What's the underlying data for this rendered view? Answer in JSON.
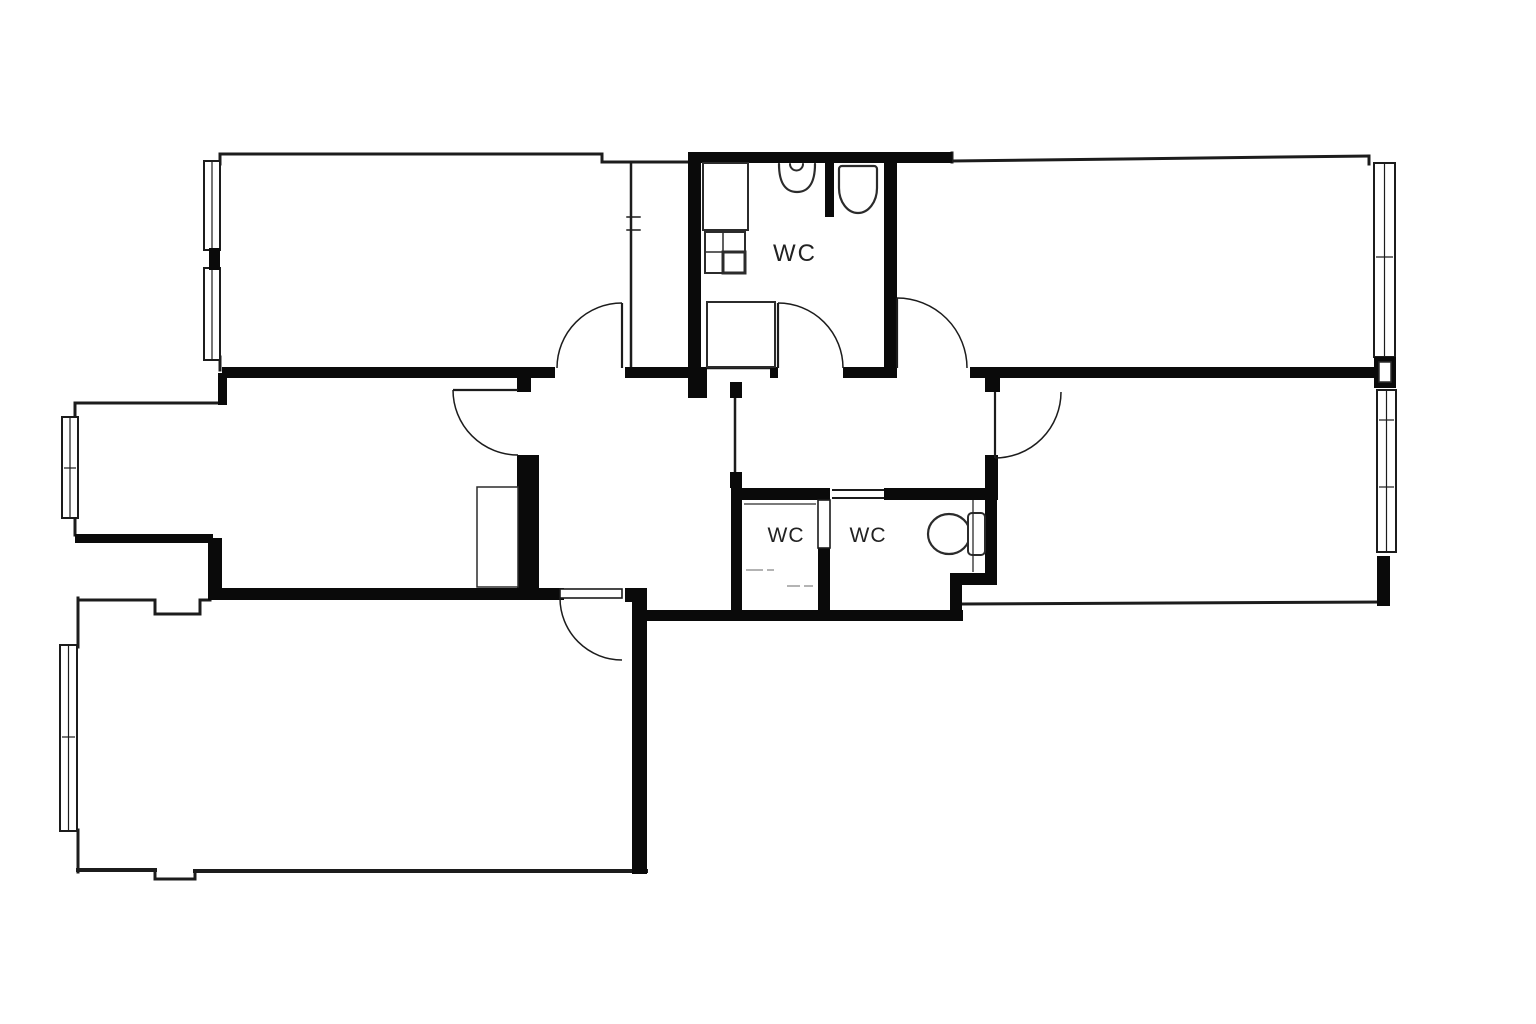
{
  "canvas": {
    "width": 1536,
    "height": 1024,
    "background": "#ffffff",
    "wall_color": "#0a0a0a",
    "line_color": "#1c1c1c",
    "fixture_color": "#2b2b2b",
    "muted_color": "#9a9a9a",
    "label_color": "#222222"
  },
  "labels": [
    {
      "id": "wc-top-label",
      "text": "WC",
      "x": 795,
      "y": 261,
      "size": 24,
      "spacing": 2
    },
    {
      "id": "wc-left-label",
      "text": "WC",
      "x": 786,
      "y": 542,
      "size": 21,
      "spacing": 1
    },
    {
      "id": "wc-right-label",
      "text": "WC",
      "x": 868,
      "y": 542,
      "size": 21,
      "spacing": 1
    }
  ],
  "thick_walls": [
    {
      "name": "spine-wall-a",
      "r": [
        222,
        367,
        333,
        11
      ]
    },
    {
      "name": "spine-wall-b",
      "r": [
        625,
        367,
        82,
        11
      ]
    },
    {
      "name": "spine-wall-jamb",
      "r": [
        770,
        367,
        8,
        11
      ]
    },
    {
      "name": "spine-wall-c",
      "r": [
        843,
        367,
        50,
        11
      ]
    },
    {
      "name": "spine-wall-d",
      "r": [
        970,
        367,
        407,
        11
      ]
    },
    {
      "name": "right-room-door-stub",
      "r": [
        985,
        375,
        15,
        17
      ]
    },
    {
      "name": "wc-top-north-wall",
      "r": [
        688,
        152,
        264,
        11
      ]
    },
    {
      "name": "wc-top-west-wall",
      "r": [
        688,
        152,
        13,
        226
      ]
    },
    {
      "name": "wc-top-west-corner",
      "r": [
        688,
        367,
        19,
        31
      ]
    },
    {
      "name": "wc-top-east-wall",
      "r": [
        884,
        152,
        13,
        226
      ]
    },
    {
      "name": "wc-top-toilet-partition",
      "r": [
        825,
        152,
        9,
        65
      ]
    },
    {
      "name": "left-room-jog",
      "r": [
        218,
        373,
        9,
        32
      ]
    },
    {
      "name": "middle-left-south-wall-a",
      "r": [
        75,
        534,
        138,
        9
      ]
    },
    {
      "name": "middle-left-south-stub",
      "r": [
        208,
        538,
        14,
        56
      ]
    },
    {
      "name": "hall-south-wall",
      "r": [
        208,
        588,
        356,
        12
      ]
    },
    {
      "name": "hall-west-stub",
      "r": [
        517,
        378,
        14,
        14
      ]
    },
    {
      "name": "hall-west-wall",
      "r": [
        517,
        455,
        22,
        135
      ]
    },
    {
      "name": "door5-jamb",
      "r": [
        625,
        588,
        22,
        14
      ]
    },
    {
      "name": "bottom-room-east-wall",
      "r": [
        632,
        598,
        15,
        276
      ]
    },
    {
      "name": "south-exterior-wall",
      "r": [
        643,
        610,
        320,
        11
      ]
    },
    {
      "name": "passage-post-top",
      "r": [
        730,
        382,
        12,
        16
      ]
    },
    {
      "name": "passage-post-bottom",
      "r": [
        730,
        472,
        12,
        16
      ]
    },
    {
      "name": "wc-left-west-wall",
      "r": [
        731,
        488,
        11,
        125
      ]
    },
    {
      "name": "wc-left-north-wall",
      "r": [
        731,
        488,
        99,
        12
      ]
    },
    {
      "name": "wc-divider-wall",
      "r": [
        818,
        548,
        12,
        65
      ]
    },
    {
      "name": "wc-right-north-wall",
      "r": [
        884,
        488,
        113,
        12
      ]
    },
    {
      "name": "wc-right-east-stub",
      "r": [
        985,
        455,
        13,
        45
      ]
    },
    {
      "name": "wc-right-east-wall",
      "r": [
        985,
        488,
        12,
        97
      ]
    },
    {
      "name": "wc-right-jut-h",
      "r": [
        950,
        573,
        47,
        12
      ]
    },
    {
      "name": "wc-right-jut-v",
      "r": [
        950,
        573,
        12,
        48
      ]
    },
    {
      "name": "window-junction-block",
      "r": [
        1374,
        357,
        22,
        31
      ]
    },
    {
      "name": "southeast-corner-wall",
      "r": [
        1377,
        556,
        13,
        50
      ]
    },
    {
      "name": "window-pier-left",
      "r": [
        209,
        248,
        11,
        22
      ]
    }
  ],
  "thin_walls": [
    {
      "name": "top-left-north-wall",
      "l": [
        222,
        154,
        602,
        154
      ],
      "w": 3
    },
    {
      "name": "top-left-north-jog-v",
      "l": [
        602,
        154,
        602,
        162
      ],
      "w": 3
    },
    {
      "name": "top-left-north-wall-b",
      "l": [
        602,
        162,
        690,
        162
      ],
      "w": 3
    },
    {
      "name": "top-left-west-stub-top",
      "l": [
        220,
        154,
        220,
        164
      ],
      "w": 3
    },
    {
      "name": "top-left-west-stub-bottom",
      "l": [
        220,
        357,
        220,
        370
      ],
      "w": 3
    },
    {
      "name": "shaft-west-wall",
      "l": [
        631,
        163,
        631,
        367
      ],
      "w": 2.5
    },
    {
      "name": "shaft-pilaster-a",
      "l": [
        627,
        217,
        640,
        217
      ],
      "w": 1.5
    },
    {
      "name": "shaft-pilaster-b",
      "l": [
        627,
        230,
        640,
        230
      ],
      "w": 1.5
    },
    {
      "name": "top-right-notch",
      "l": [
        952,
        153,
        952,
        162
      ],
      "w": 3
    },
    {
      "name": "top-right-north-wall",
      "l": [
        952,
        161,
        1369,
        156
      ],
      "w": 3
    },
    {
      "name": "top-right-ne-corner",
      "l": [
        1369,
        156,
        1369,
        164
      ],
      "w": 3
    },
    {
      "name": "right-room-south-wall",
      "l": [
        962,
        604,
        1386,
        602
      ],
      "w": 3
    },
    {
      "name": "shower-threshold",
      "l": [
        707,
        368,
        770,
        368
      ],
      "w": 2.5
    },
    {
      "name": "passage-screen",
      "l": [
        735,
        398,
        735,
        472
      ],
      "w": 2.5
    },
    {
      "name": "bottom-room-north-wall-a",
      "l": [
        80,
        600,
        155,
        600
      ],
      "w": 3
    },
    {
      "name": "bottom-room-notch-a",
      "l": [
        155,
        600,
        155,
        614
      ],
      "w": 3
    },
    {
      "name": "bottom-room-notch-b",
      "l": [
        155,
        614,
        200,
        614
      ],
      "w": 3
    },
    {
      "name": "bottom-room-notch-c",
      "l": [
        200,
        614,
        200,
        600
      ],
      "w": 3
    },
    {
      "name": "bottom-room-north-wall-b",
      "l": [
        200,
        600,
        210,
        600
      ],
      "w": 3
    },
    {
      "name": "bottom-room-west-wall-top",
      "l": [
        78,
        598,
        78,
        647
      ],
      "w": 3
    },
    {
      "name": "bottom-room-west-wall-bottom",
      "l": [
        78,
        830,
        78,
        872
      ],
      "w": 3
    },
    {
      "name": "bottom-room-south-wall-a",
      "l": [
        78,
        870,
        155,
        870
      ],
      "w": 4
    },
    {
      "name": "bottom-south-notch-a",
      "l": [
        155,
        870,
        155,
        879
      ],
      "w": 3
    },
    {
      "name": "bottom-south-notch-b",
      "l": [
        155,
        879,
        195,
        879
      ],
      "w": 3
    },
    {
      "name": "bottom-south-notch-c",
      "l": [
        195,
        879,
        195,
        871
      ],
      "w": 3
    },
    {
      "name": "bottom-room-south-wall-b",
      "l": [
        195,
        871,
        646,
        871
      ],
      "w": 4
    },
    {
      "name": "middle-left-north-wall",
      "l": [
        75,
        403,
        218,
        403
      ],
      "w": 3
    },
    {
      "name": "middle-left-west-stub-top",
      "l": [
        75,
        403,
        75,
        418
      ],
      "w": 3
    },
    {
      "name": "middle-left-west-stub-bottom",
      "l": [
        75,
        517,
        75,
        535
      ],
      "w": 3
    },
    {
      "name": "wc-right-threshold-a",
      "l": [
        833,
        490,
        883,
        490
      ],
      "w": 2
    },
    {
      "name": "wc-right-threshold-b",
      "l": [
        833,
        498,
        883,
        498
      ],
      "w": 2
    }
  ],
  "windows": [
    {
      "name": "window-top-left-1",
      "x": 204,
      "y": 161,
      "w": 16,
      "h": 89,
      "ticks": []
    },
    {
      "name": "window-top-left-2",
      "x": 204,
      "y": 268,
      "w": 16,
      "h": 92,
      "ticks": []
    },
    {
      "name": "window-middle-left",
      "x": 62,
      "y": 417,
      "w": 16,
      "h": 101,
      "ticks": [
        468
      ]
    },
    {
      "name": "window-bottom-left",
      "x": 60,
      "y": 645,
      "w": 17,
      "h": 186,
      "ticks": [
        737
      ]
    },
    {
      "name": "window-top-right",
      "x": 1374,
      "y": 163,
      "w": 21,
      "h": 194,
      "ticks": [
        257
      ]
    },
    {
      "name": "window-right-middle",
      "x": 1377,
      "y": 390,
      "w": 19,
      "h": 162,
      "ticks": [
        420,
        487
      ]
    }
  ],
  "doors": [
    {
      "name": "door-top-left-room",
      "leaf": [
        622,
        303,
        622,
        368
      ],
      "arc": "M622,303 A65,65 0 0 0 557,368"
    },
    {
      "name": "door-wc-top",
      "leaf": [
        778,
        303,
        778,
        368
      ],
      "arc": "M778,303 A65,65 0 0 1 843,368"
    },
    {
      "name": "door-top-right-room",
      "leaf": [
        897,
        298,
        897,
        368
      ],
      "arc": "M897,298 A70,70 0 0 1 967,368"
    },
    {
      "name": "door-middle-left-room",
      "leaf": [
        453,
        390,
        518,
        390
      ],
      "arc": "M453,390 A65,65 0 0 0 518,455"
    },
    {
      "name": "door-bottom-left-room",
      "leaf_rect": [
        560,
        589,
        62,
        9
      ],
      "arc": "M560,598 A62,62 0 0 0 622,660"
    },
    {
      "name": "door-right-room",
      "leaf": [
        995,
        392,
        995,
        458
      ],
      "arc": "M995,458 A66,66 0 0 0 1061,392"
    },
    {
      "name": "door-wc-left-leaf",
      "leaf_rect": [
        818,
        500,
        12,
        48
      ]
    }
  ],
  "fixtures": [
    {
      "name": "wc-counter",
      "type": "rect",
      "x": 703,
      "y": 163,
      "w": 45,
      "h": 67,
      "sw": 2
    },
    {
      "name": "wc-cabinet",
      "type": "rect",
      "x": 705,
      "y": 232,
      "w": 40,
      "h": 41,
      "sw": 2
    },
    {
      "name": "wc-cabinet-shelf-line",
      "type": "line",
      "x1": 705,
      "y1": 252,
      "x2": 745,
      "y2": 252,
      "sw": 1.5
    },
    {
      "name": "wc-cabinet-divider-line",
      "type": "line",
      "x1": 723,
      "y1": 232,
      "x2": 723,
      "y2": 252,
      "sw": 1.5
    },
    {
      "name": "wc-cabinet-box",
      "type": "rect",
      "x": 723,
      "y": 252,
      "w": 22,
      "h": 21,
      "sw": 3
    },
    {
      "name": "shower-tray",
      "type": "rect",
      "x": 707,
      "y": 302,
      "w": 68,
      "h": 65,
      "sw": 2
    },
    {
      "name": "sink-basin",
      "type": "path",
      "d": "M779,164 C779,185 787,192 797,192 C807,192 815,185 815,164",
      "sw": 2.2
    },
    {
      "name": "sink-faucet",
      "type": "path",
      "d": "M790,164 a6.5,6.5 0 0 0 13,0",
      "sw": 2
    },
    {
      "name": "toilet-top",
      "type": "path",
      "d": "M842,166 h32 a3,3 0 0 1 3,3 v19 a19,25 0 0 1 -38,0 v-19 a3,3 0 0 1 3,-3 z",
      "sw": 2.2
    },
    {
      "name": "toilet-mid-bowl",
      "type": "ellipse",
      "cx": 949,
      "cy": 534,
      "rx": 21,
      "ry": 20,
      "sw": 2.2
    },
    {
      "name": "toilet-mid-tank",
      "type": "rect",
      "x": 968,
      "y": 513,
      "w": 17,
      "h": 42,
      "rx": 4,
      "sw": 2
    },
    {
      "name": "hall-wardrobe",
      "type": "rect",
      "x": 477,
      "y": 487,
      "w": 41,
      "h": 100,
      "sw": 1.5
    },
    {
      "name": "pocket-door-track",
      "type": "line",
      "x1": 744,
      "y1": 504,
      "x2": 816,
      "y2": 504,
      "sw": 1.3
    },
    {
      "name": "wc-dash-1",
      "type": "line",
      "x1": 746,
      "y1": 570,
      "x2": 763,
      "y2": 570,
      "sw": 1.5,
      "muted": true
    },
    {
      "name": "wc-dash-2",
      "type": "line",
      "x1": 767,
      "y1": 570,
      "x2": 774,
      "y2": 570,
      "sw": 1.5,
      "muted": true
    },
    {
      "name": "wc-dash-3",
      "type": "line",
      "x1": 787,
      "y1": 586,
      "x2": 800,
      "y2": 586,
      "sw": 1.5,
      "muted": true
    },
    {
      "name": "wc-dash-4",
      "type": "line",
      "x1": 804,
      "y1": 586,
      "x2": 813,
      "y2": 586,
      "sw": 1.5,
      "muted": true
    },
    {
      "name": "wc-partition-line",
      "type": "line",
      "x1": 973,
      "y1": 500,
      "x2": 973,
      "y2": 572,
      "sw": 1.3
    },
    {
      "name": "junction-block-inner",
      "type": "rect",
      "x": 1379,
      "y": 362,
      "w": 12,
      "h": 20,
      "sw": 1.5,
      "fill": "#ffffff"
    }
  ]
}
